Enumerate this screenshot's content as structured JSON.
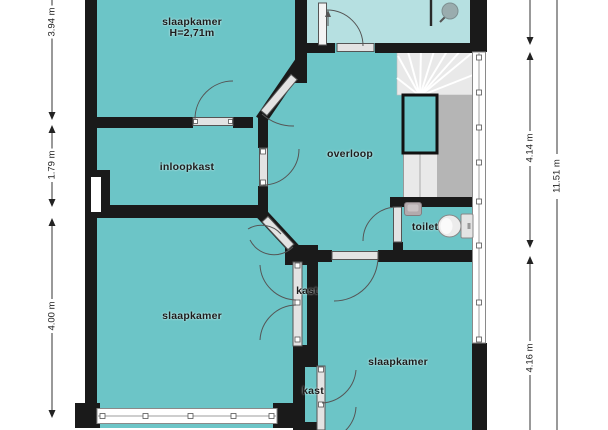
{
  "floorplan": {
    "rooms": [
      {
        "id": "bedroom-top-left",
        "label": "slaapkamer",
        "height_label": "H=2,71m"
      },
      {
        "id": "walk-in-closet",
        "label": "inloopkast"
      },
      {
        "id": "landing",
        "label": "overloop"
      },
      {
        "id": "toilet",
        "label": "toilet"
      },
      {
        "id": "closet-upper",
        "label": "kast"
      },
      {
        "id": "bedroom-bottom-left",
        "label": "slaapkamer"
      },
      {
        "id": "closet-lower",
        "label": "kast"
      },
      {
        "id": "bedroom-bottom-right",
        "label": "slaapkamer"
      }
    ],
    "dimensions": {
      "left": [
        "3.94 m",
        "1.79 m",
        "4.00 m"
      ],
      "right_inner": [
        "4.14 m",
        "4.16 m"
      ],
      "right_outer": [
        "11.51 m"
      ]
    },
    "fixtures": [
      "staircase",
      "shower",
      "wc",
      "washbasin"
    ],
    "colors": {
      "room_fill": "#6cc5c7",
      "bathroom_fill": "#b6e0e1",
      "wall": "#1a1a1a",
      "stair_light": "#e9e9e9",
      "stair_dark": "#b5b5b5"
    }
  }
}
